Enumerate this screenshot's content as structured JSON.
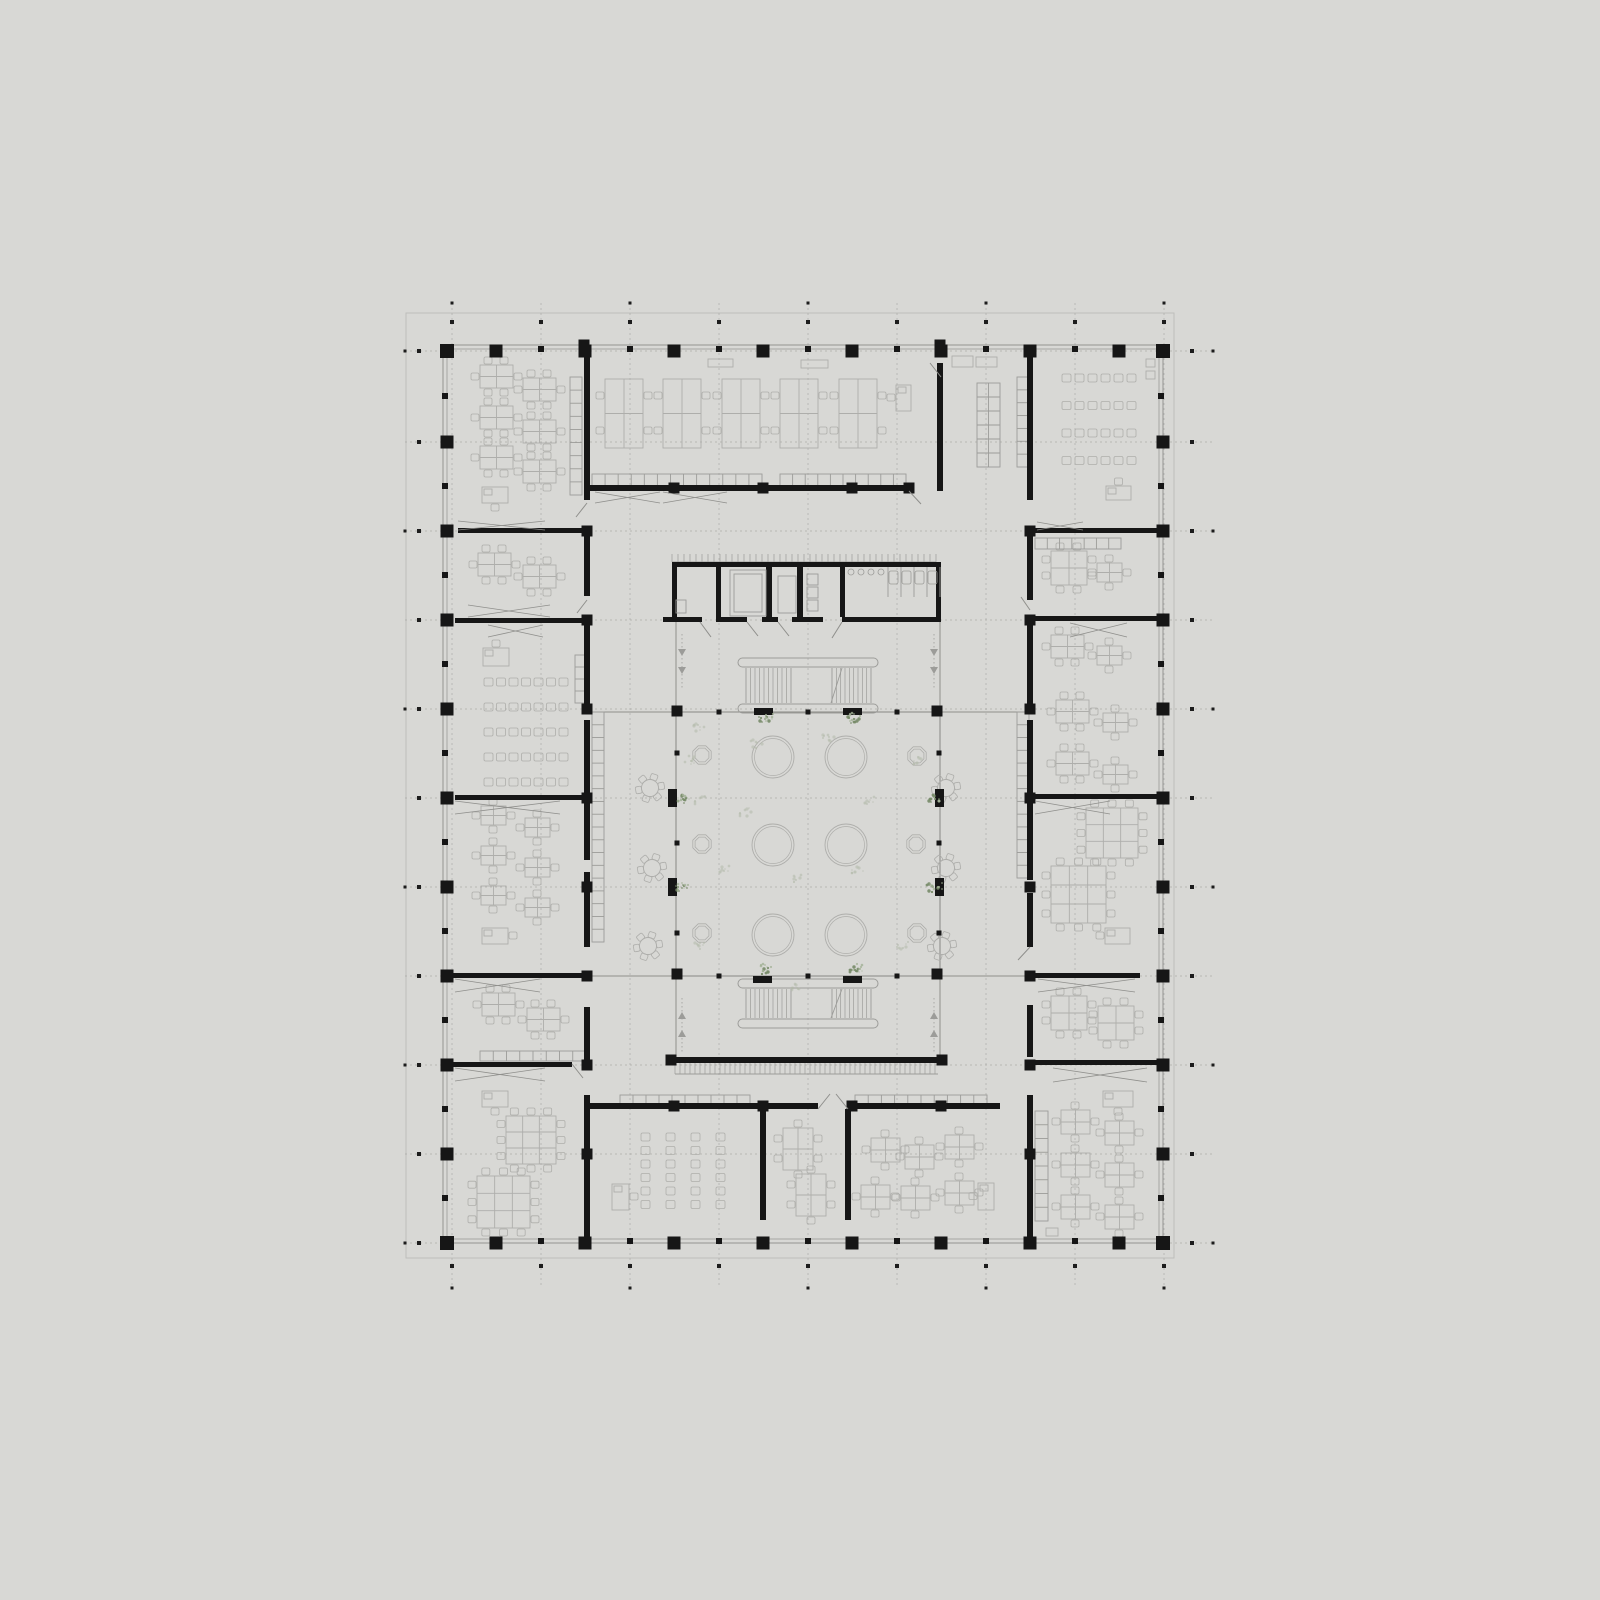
{
  "colors": {
    "bg": "#d8d8d5",
    "sheet_line": "#bebebb",
    "wall_black": "#161616",
    "thin_wall": "#8f8f8c",
    "shell_line": "#9a9a97",
    "furniture": "#aeaeab",
    "furniture_dark": "#9c9c99",
    "dash_line": "#a6a6a3",
    "tick_black": "#1c1c1c",
    "plant_green": "#778b68",
    "plant_light": "#a3b296",
    "scatter_gray": "#b3baa9"
  },
  "sheet": {
    "x": 406,
    "y": 313,
    "w": 768,
    "h": 945
  },
  "building": {
    "x": 443,
    "y": 345,
    "w": 720,
    "h": 898,
    "inset": 4
  },
  "grid": {
    "axes_x": [
      452,
      541,
      630,
      719,
      808,
      897,
      986,
      1075,
      1164
    ],
    "rows_y": [
      351,
      442,
      531,
      620,
      709,
      798,
      887,
      976,
      1065,
      1154,
      1243
    ],
    "cols_x": [
      496,
      585,
      674,
      763,
      852,
      941,
      1030,
      1119
    ],
    "row_mids": [
      396,
      486,
      575,
      664,
      753,
      842,
      931,
      1020,
      1109,
      1198
    ],
    "dash_top": 303,
    "dash_bottom": 1288,
    "dash_left": 405,
    "dash_right": 1213,
    "tick_top": 322,
    "tick_bottom": 1266,
    "tick_left": 419,
    "tick_right": 1192,
    "dot_top": 303,
    "dot_bottom": 1288,
    "dot_left": 405,
    "dot_right": 1213
  },
  "atrium": {
    "x": 676,
    "y": 712,
    "w": 264,
    "h": 264
  },
  "core": {
    "x": 672,
    "y": 562,
    "w": 269,
    "h": 60
  },
  "thin_lines": [
    [
      676,
      622,
      676,
      712
    ],
    [
      940,
      622,
      940,
      712
    ],
    [
      676,
      976,
      676,
      1057
    ],
    [
      940,
      976,
      940,
      1057
    ],
    [
      587,
      712,
      676,
      712
    ],
    [
      940,
      712,
      1030,
      712
    ],
    [
      587,
      976,
      676,
      976
    ],
    [
      940,
      976,
      1030,
      976
    ]
  ],
  "walls": [
    [
      584,
      345,
      6,
      155
    ],
    [
      584,
      526,
      6,
      70
    ],
    [
      584,
      618,
      6,
      90
    ],
    [
      584,
      720,
      6,
      140
    ],
    [
      584,
      872,
      6,
      75
    ],
    [
      584,
      1007,
      6,
      60
    ],
    [
      584,
      1095,
      6,
      142
    ],
    [
      1027,
      357,
      6,
      143
    ],
    [
      1027,
      526,
      6,
      74
    ],
    [
      1027,
      618,
      6,
      90
    ],
    [
      1027,
      720,
      6,
      160
    ],
    [
      1027,
      893,
      6,
      54
    ],
    [
      1027,
      1005,
      6,
      52
    ],
    [
      1027,
      1095,
      6,
      142
    ],
    [
      584,
      485,
      325,
      6
    ],
    [
      937,
      363,
      6,
      128
    ],
    [
      937,
      345,
      6,
      12
    ],
    [
      458,
      528,
      132,
      5
    ],
    [
      455,
      618,
      135,
      5
    ],
    [
      455,
      795,
      135,
      5
    ],
    [
      443,
      973,
      147,
      5
    ],
    [
      445,
      1062,
      127,
      5
    ],
    [
      1027,
      528,
      136,
      5
    ],
    [
      1027,
      616,
      136,
      5
    ],
    [
      1033,
      794,
      130,
      5
    ],
    [
      1027,
      973,
      113,
      5
    ],
    [
      1027,
      1060,
      136,
      5
    ],
    [
      584,
      1103,
      234,
      6
    ],
    [
      848,
      1103,
      152,
      6
    ],
    [
      760,
      1109,
      6,
      111
    ],
    [
      845,
      1109,
      6,
      111
    ],
    [
      672,
      562,
      269,
      5
    ],
    [
      672,
      567,
      5,
      55
    ],
    [
      936,
      567,
      5,
      55
    ],
    [
      663,
      617,
      39,
      5
    ],
    [
      716,
      617,
      31,
      5
    ],
    [
      762,
      617,
      16,
      5
    ],
    [
      792,
      617,
      31,
      5
    ],
    [
      842,
      617,
      99,
      5
    ],
    [
      716,
      567,
      5,
      50
    ],
    [
      766,
      567,
      6,
      50
    ],
    [
      797,
      567,
      6,
      50
    ],
    [
      840,
      567,
      5,
      50
    ],
    [
      669,
      1057,
      276,
      6
    ]
  ],
  "blocks": [
    [
      587,
      531
    ],
    [
      587,
      620
    ],
    [
      587,
      709
    ],
    [
      587,
      798
    ],
    [
      587,
      887
    ],
    [
      587,
      976
    ],
    [
      587,
      1065
    ],
    [
      587,
      1154
    ],
    [
      1030,
      531
    ],
    [
      1030,
      620
    ],
    [
      1030,
      709
    ],
    [
      1030,
      798
    ],
    [
      1030,
      887
    ],
    [
      1030,
      976
    ],
    [
      1030,
      1065
    ],
    [
      1030,
      1154
    ],
    [
      674,
      488
    ],
    [
      763,
      488
    ],
    [
      852,
      488
    ],
    [
      909,
      488
    ],
    [
      674,
      1106
    ],
    [
      763,
      1106
    ],
    [
      852,
      1106
    ],
    [
      941,
      1106
    ],
    [
      671,
      1060
    ],
    [
      942,
      1060
    ],
    [
      677,
      711
    ],
    [
      937,
      711
    ],
    [
      677,
      974
    ],
    [
      937,
      974
    ],
    [
      584,
      345
    ],
    [
      940,
      345
    ]
  ],
  "atrium_cols": [
    [
      668,
      789
    ],
    [
      935,
      789
    ],
    [
      668,
      878
    ],
    [
      935,
      878
    ]
  ],
  "atrium_mulls": [
    [
      719,
      712
    ],
    [
      808,
      712
    ],
    [
      897,
      712
    ],
    [
      719,
      976
    ],
    [
      808,
      976
    ],
    [
      897,
      976
    ],
    [
      677,
      753
    ],
    [
      677,
      843
    ],
    [
      677,
      933
    ],
    [
      939,
      753
    ],
    [
      939,
      843
    ],
    [
      939,
      933
    ]
  ],
  "stairs": [
    [
      738,
      658,
      140,
      55
    ],
    [
      738,
      979,
      140,
      49
    ]
  ],
  "planters": [
    [
      754,
      708
    ],
    [
      843,
      708
    ],
    [
      753,
      976
    ],
    [
      843,
      976
    ]
  ],
  "furniture": {
    "islands": [
      [
        605,
        379
      ],
      [
        663,
        379
      ],
      [
        722,
        379
      ],
      [
        780,
        379
      ],
      [
        839,
        379
      ]
    ],
    "c6": [
      [
        480,
        365
      ],
      [
        523,
        378
      ],
      [
        480,
        406
      ],
      [
        523,
        420
      ],
      [
        480,
        446
      ],
      [
        523,
        460
      ],
      [
        478,
        553
      ],
      [
        523,
        565
      ],
      [
        482,
        993
      ],
      [
        527,
        1008
      ],
      [
        1051,
        635
      ],
      [
        1056,
        700
      ],
      [
        1056,
        752
      ]
    ],
    "c4": [
      [
        481,
        806
      ],
      [
        525,
        818
      ],
      [
        481,
        846
      ],
      [
        525,
        858
      ],
      [
        481,
        886
      ],
      [
        525,
        898
      ],
      [
        1097,
        646
      ],
      [
        1103,
        713
      ],
      [
        1103,
        765
      ],
      [
        1097,
        563
      ]
    ],
    "c4b": [
      [
        871,
        1138
      ],
      [
        905,
        1145
      ],
      [
        945,
        1135
      ],
      [
        861,
        1185
      ],
      [
        901,
        1186
      ],
      [
        945,
        1181
      ],
      [
        1061,
        1110
      ],
      [
        1105,
        1121
      ],
      [
        1061,
        1153
      ],
      [
        1105,
        1163
      ],
      [
        1061,
        1195
      ],
      [
        1105,
        1205
      ]
    ],
    "c8": [
      [
        1051,
        551
      ],
      [
        1051,
        996
      ],
      [
        1098,
        1006
      ]
    ],
    "c6v": [
      [
        783,
        1128
      ],
      [
        796,
        1174
      ]
    ],
    "c12": [
      [
        506,
        1116,
        50,
        48
      ],
      [
        477,
        1176,
        53,
        52
      ],
      [
        1086,
        808,
        52,
        50
      ],
      [
        1051,
        866,
        55,
        57
      ]
    ],
    "desks": [
      [
        896,
        385,
        15,
        26,
        "l"
      ],
      [
        482,
        487,
        26,
        16,
        "b"
      ],
      [
        482,
        928,
        26,
        16,
        "r"
      ],
      [
        482,
        1091,
        26,
        16,
        "b"
      ],
      [
        1106,
        486,
        25,
        14,
        "t"
      ],
      [
        1105,
        928,
        25,
        16,
        "l"
      ],
      [
        1103,
        1091,
        30,
        16,
        "b"
      ],
      [
        612,
        1184,
        17,
        26,
        "r"
      ],
      [
        978,
        1183,
        16,
        27,
        "l"
      ],
      [
        483,
        648,
        26,
        18,
        "t"
      ]
    ],
    "chairgrids": [
      {
        "x": 484,
        "y": 678,
        "cols": 7,
        "rows": 5,
        "dx": 12.5,
        "dy": 25
      },
      {
        "x": 1062,
        "y": 374,
        "cols": 6,
        "rows": 4,
        "dx": 13,
        "dy": 27.5
      },
      {
        "x": 641,
        "y": 1133,
        "cols": 4,
        "rows": 6,
        "dx": 25,
        "dy": 13.5
      }
    ],
    "boxes": [
      [
        708,
        359,
        25,
        8
      ],
      [
        801,
        360,
        27,
        8
      ],
      [
        952,
        356,
        21,
        11
      ],
      [
        976,
        357,
        21,
        10
      ],
      [
        1146,
        359,
        9,
        8
      ],
      [
        1146,
        371,
        9,
        8
      ],
      [
        1046,
        1228,
        12,
        8
      ]
    ],
    "gears": [
      [
        650,
        788
      ],
      [
        652,
        868
      ],
      [
        648,
        946
      ],
      [
        946,
        788
      ],
      [
        946,
        868
      ],
      [
        942,
        946
      ]
    ],
    "octagons": [
      [
        702,
        755
      ],
      [
        702,
        844
      ],
      [
        702,
        933
      ],
      [
        917,
        756
      ],
      [
        916,
        844
      ],
      [
        917,
        933
      ]
    ],
    "circles": [
      [
        773,
        757
      ],
      [
        846,
        757
      ],
      [
        773,
        845
      ],
      [
        846,
        845
      ],
      [
        773,
        935
      ],
      [
        846,
        935
      ]
    ],
    "shelves_v": [
      [
        570,
        377,
        12,
        118
      ],
      [
        592,
        712,
        12,
        230
      ],
      [
        1017,
        712,
        12,
        166
      ],
      [
        1017,
        377,
        12,
        90
      ],
      [
        1035,
        1111,
        13,
        110
      ],
      [
        575,
        655,
        10,
        48
      ]
    ],
    "shelves_h": [
      [
        592,
        474,
        170,
        12
      ],
      [
        780,
        474,
        126,
        12
      ],
      [
        1035,
        538,
        86,
        11
      ],
      [
        480,
        1051,
        106,
        10
      ],
      [
        620,
        1095,
        130,
        10
      ],
      [
        855,
        1095,
        132,
        10
      ]
    ],
    "shelf_grid": [
      977,
      383,
      23,
      84
    ],
    "hatches": [
      [
        672,
        554,
        264,
        8,
        6
      ],
      [
        675,
        1063,
        263,
        11,
        5
      ]
    ]
  },
  "core_fixtures": {
    "rects": [
      [
        730,
        570,
        36,
        46
      ],
      [
        734,
        574,
        28,
        38
      ],
      [
        778,
        576,
        18,
        37
      ],
      [
        807,
        574,
        11,
        11
      ],
      [
        807,
        587,
        11,
        11
      ],
      [
        807,
        600,
        11,
        11
      ],
      [
        676,
        600,
        10,
        13
      ]
    ],
    "sinks": [
      [
        851,
        572
      ],
      [
        861,
        572
      ],
      [
        871,
        572
      ],
      [
        881,
        572
      ]
    ],
    "stall_xs": [
      888,
      901,
      914,
      927,
      940
    ],
    "stall_y1": 567,
    "stall_y2": 597,
    "toilets": [
      [
        889,
        571
      ],
      [
        902,
        571
      ],
      [
        915,
        571
      ],
      [
        928,
        571
      ]
    ]
  },
  "doors": {
    "bowties": [
      [
        458,
        545,
        521,
        9
      ],
      [
        468,
        550,
        605,
        12
      ],
      [
        488,
        543,
        625,
        12
      ],
      [
        455,
        560,
        801,
        13
      ],
      [
        455,
        540,
        979,
        13
      ],
      [
        455,
        545,
        1068,
        13
      ],
      [
        1037,
        1083,
        522,
        8
      ],
      [
        1070,
        1127,
        623,
        14
      ],
      [
        1035,
        1110,
        801,
        13
      ],
      [
        1038,
        1135,
        979,
        13
      ],
      [
        1053,
        1147,
        1068,
        14
      ],
      [
        595,
        660,
        492,
        11
      ],
      [
        663,
        727,
        492,
        11
      ]
    ],
    "leafs": [
      [
        587,
        503,
        576,
        517
      ],
      [
        587,
        600,
        577,
        613
      ],
      [
        700,
        622,
        711,
        637
      ],
      [
        747,
        622,
        758,
        636
      ],
      [
        778,
        622,
        789,
        636
      ],
      [
        842,
        622,
        832,
        638
      ],
      [
        930,
        363,
        941,
        377
      ],
      [
        909,
        491,
        921,
        504
      ],
      [
        818,
        1109,
        830,
        1094
      ],
      [
        848,
        1109,
        836,
        1094
      ],
      [
        1030,
        947,
        1018,
        960
      ],
      [
        572,
        1064,
        583,
        1078
      ],
      [
        1021,
        597,
        1030,
        610
      ]
    ]
  },
  "zigzags": [
    [
      682,
      634,
      "u"
    ],
    [
      934,
      634,
      "u"
    ],
    [
      682,
      998,
      "d"
    ],
    [
      934,
      998,
      "d"
    ]
  ],
  "plants_green": [
    [
      764,
      719
    ],
    [
      853,
      719
    ],
    [
      764,
      970
    ],
    [
      853,
      970
    ],
    [
      681,
      799
    ],
    [
      681,
      888
    ],
    [
      933,
      799
    ],
    [
      933,
      888
    ]
  ],
  "plants_faint": [
    [
      700,
      728
    ],
    [
      757,
      744
    ],
    [
      828,
      737
    ],
    [
      745,
      812
    ],
    [
      868,
      800
    ],
    [
      723,
      869
    ],
    [
      795,
      878
    ],
    [
      700,
      947
    ],
    [
      903,
      946
    ],
    [
      858,
      869
    ],
    [
      795,
      988
    ],
    [
      700,
      800
    ],
    [
      688,
      760
    ],
    [
      920,
      760
    ]
  ]
}
